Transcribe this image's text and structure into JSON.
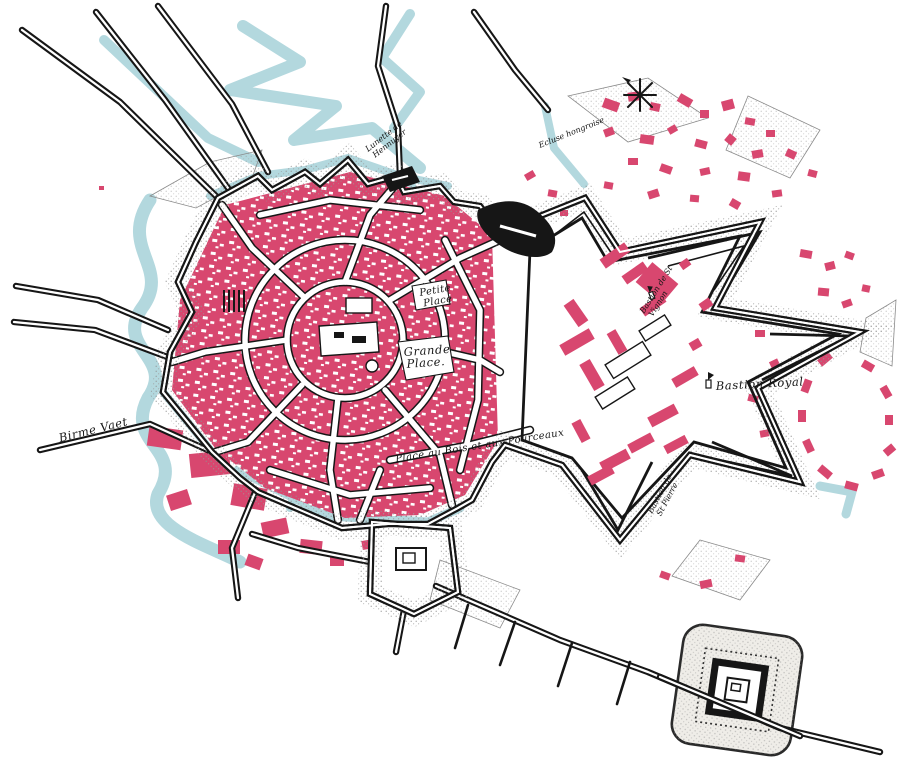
{
  "map": {
    "labels": {
      "petite_1": "Petite",
      "petite_2": "Place",
      "grande_1": "Grande",
      "grande_2": "Place.",
      "bastion_royal": "Bastion Royal",
      "place_au_bois": "Place au Bois et aux Pourceaux",
      "birme_vaet": "Birme Vaet",
      "lunette_1": "Lunette de",
      "lunette_2": "Hennuyer",
      "ecluse": "Ecluse hongroise",
      "st_vignon_1": "Bastion de St",
      "st_vignon_2": "Vignon",
      "st_pierre_1": "Bastion de",
      "st_pierre_2": "St Pierre"
    },
    "colors": {
      "building_pink": "#d8476f",
      "water_blue": "#b3d8de",
      "ink_black": "#161616",
      "stipple_gray": "#8f8f8f",
      "paper_white": "#ffffff"
    },
    "icons": [
      {
        "name": "compass-rose-icon"
      },
      {
        "name": "flag-marker-icon"
      }
    ]
  }
}
